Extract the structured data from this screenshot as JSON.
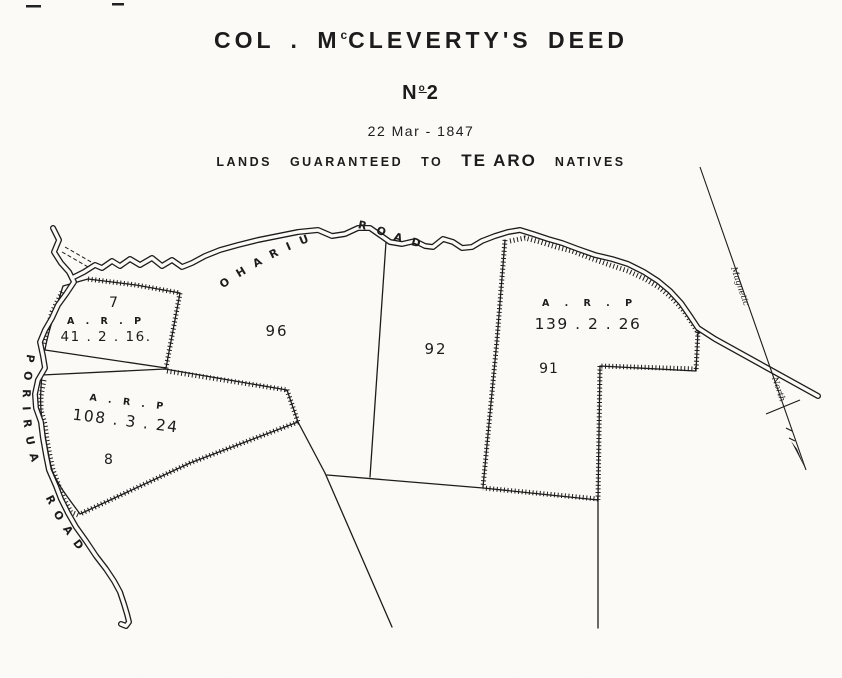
{
  "header": {
    "title": {
      "pre": "COL . M",
      "sup": "c",
      "post": "CLEVERTY'S DEED"
    },
    "number": {
      "pre": "N",
      "sup": "o",
      "post": "2"
    },
    "date": "22 Mar - 1847",
    "subtitle": {
      "lead": "LANDS",
      "mid": "GUARANTEED",
      "to": "TO",
      "emph": "TE ARO",
      "tail": "NATIVES"
    }
  },
  "map": {
    "roads": {
      "ohariu_label": "OHARIU ROAD",
      "porirua_label": "PORIRUA ROAD"
    },
    "north_marker": {
      "word1": "Magnetic",
      "word2": "North"
    },
    "parcels": [
      {
        "number": "7",
        "arp_label": "A . R . P",
        "area": "41 . 2 . 16."
      },
      {
        "number": "8",
        "arp_label": "A . R . P",
        "area": "108 . 3 . 24"
      },
      {
        "number": "96"
      },
      {
        "number": "92"
      },
      {
        "number": "91",
        "arp_label": "A . R . P",
        "area": "139 . 2 . 26"
      }
    ],
    "ink_color": "#1c1c1c",
    "paper_color": "#fbfaf6"
  }
}
